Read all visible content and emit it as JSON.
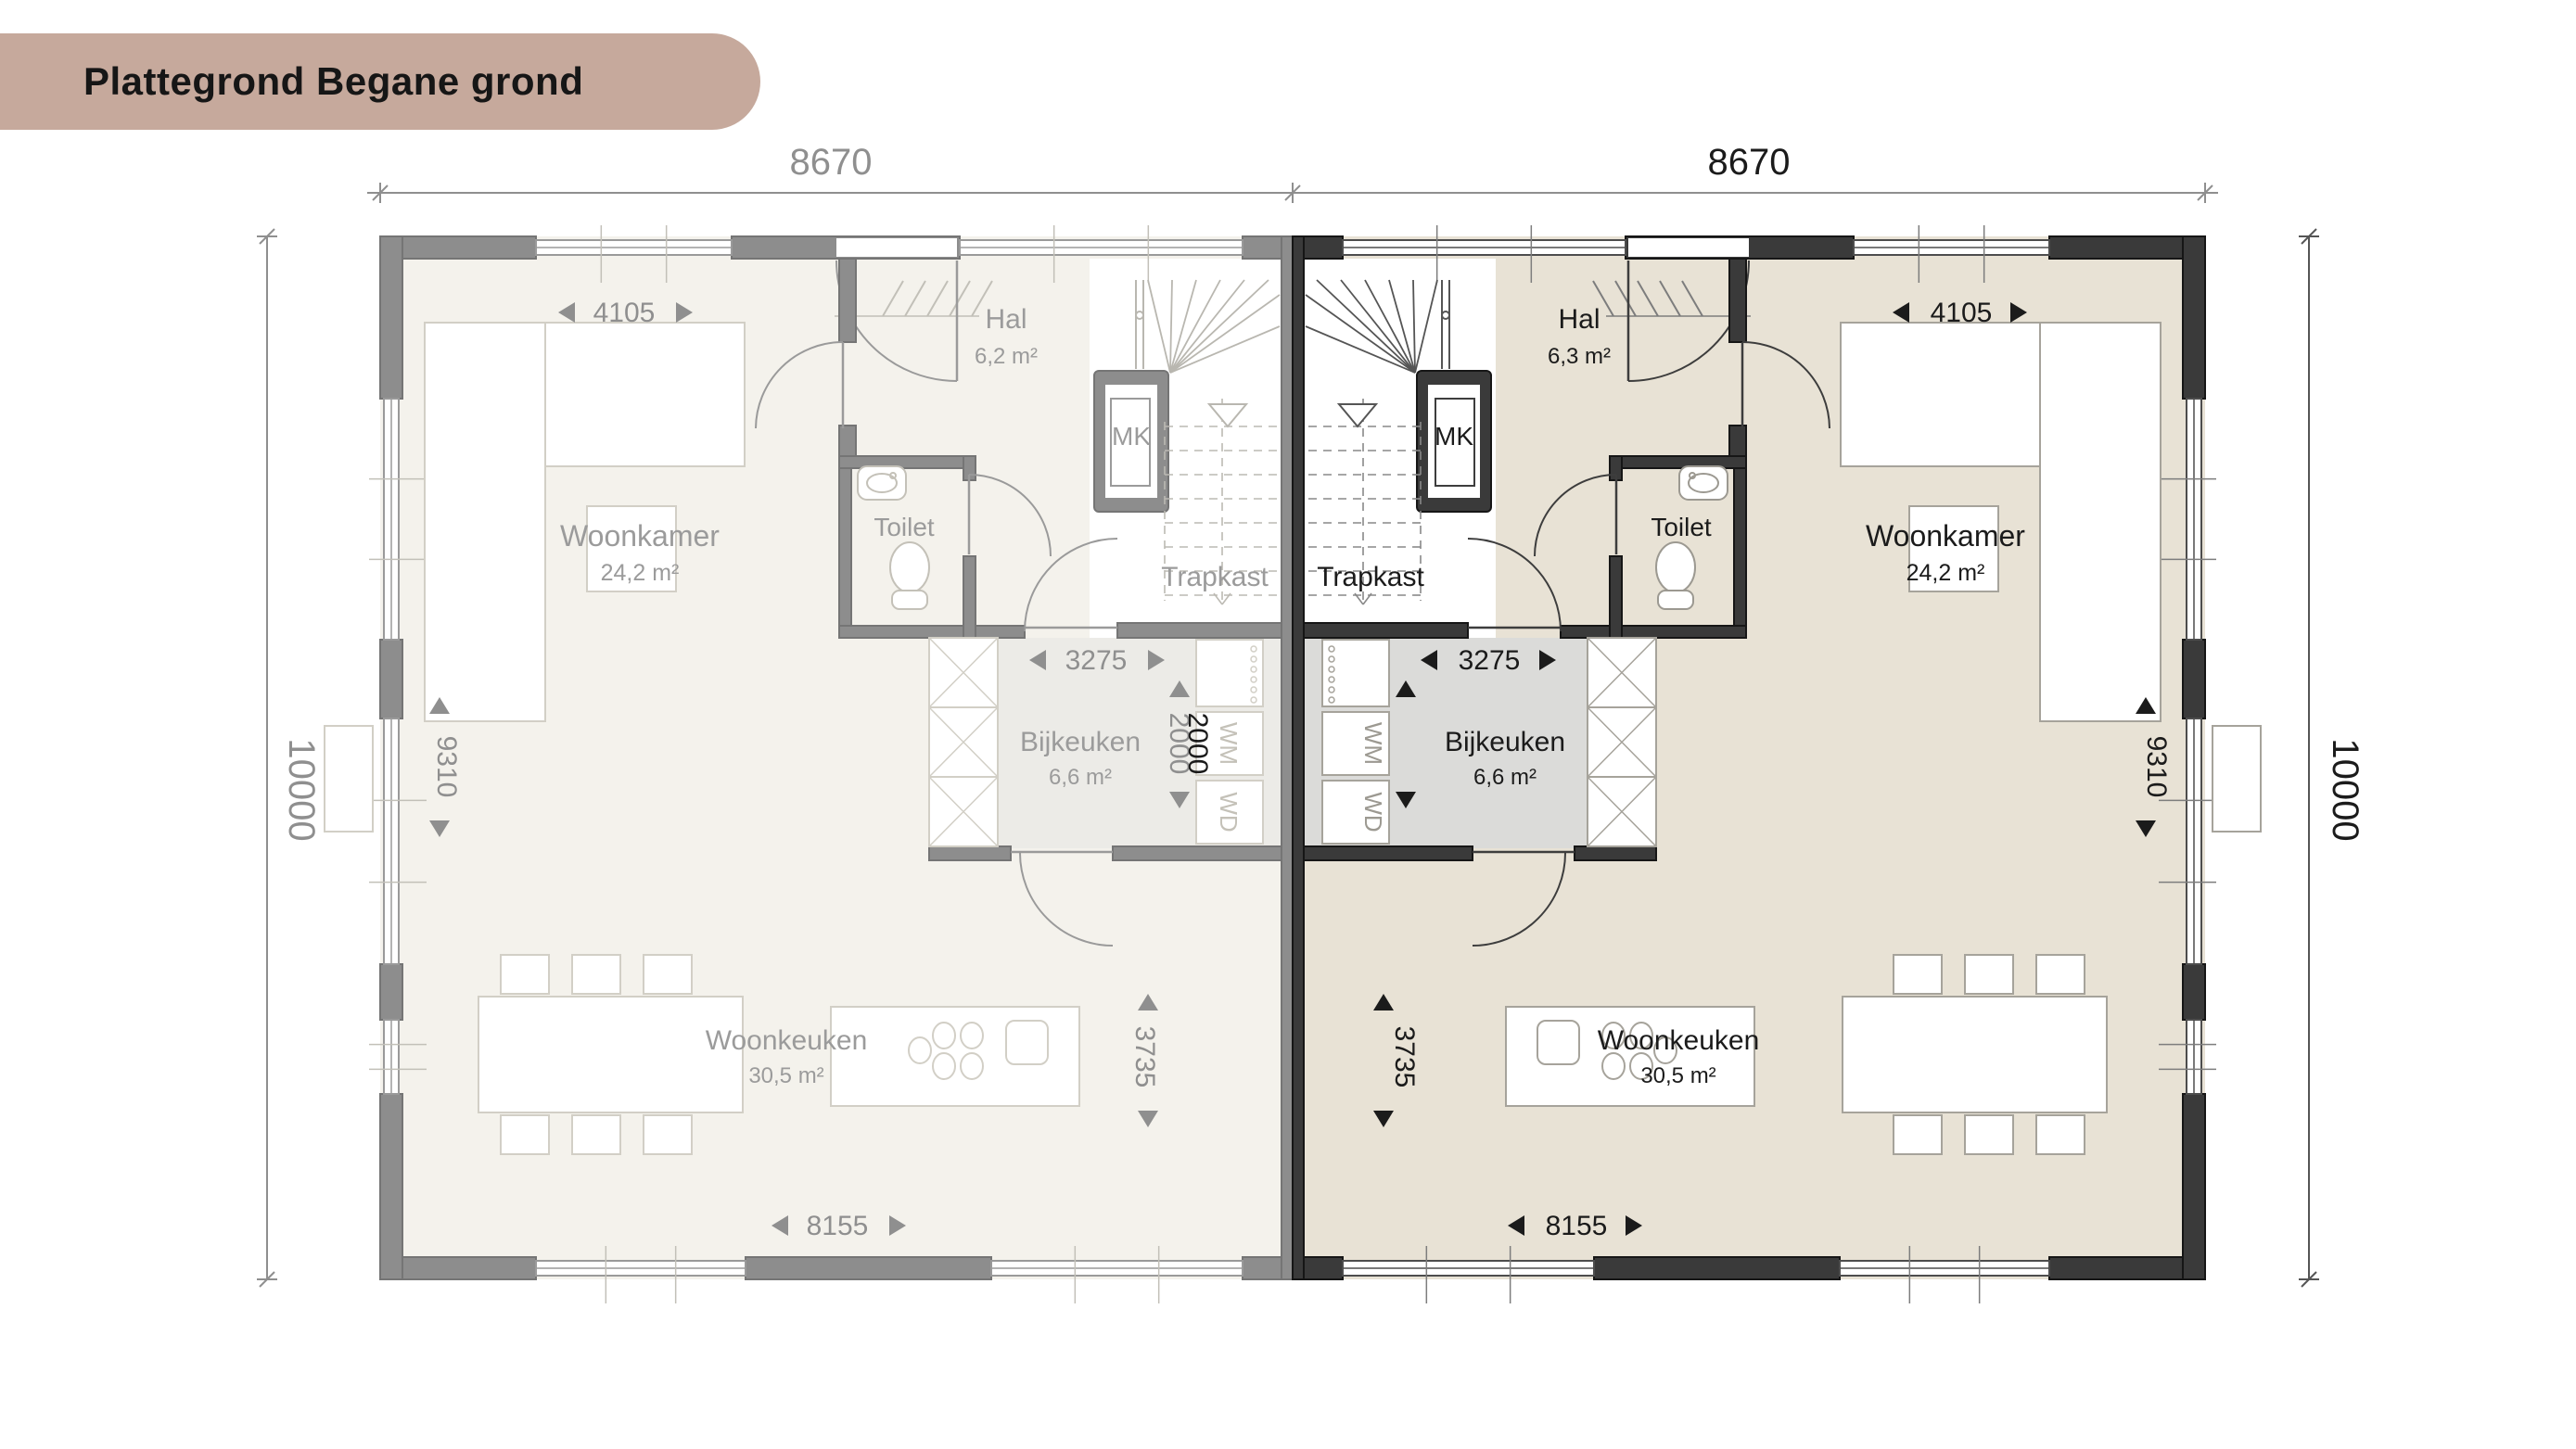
{
  "title": "Plattegrond Begane grond",
  "colors": {
    "badge": "#c6a99c",
    "left_wall": "#8d8d8d",
    "left_floor": "#f4f2ec",
    "right_wall": "#3a3a3a",
    "right_floor": "#e8e2d5",
    "left_dim_text": "#8f8f8f",
    "right_dim_text": "#1b1b1b"
  },
  "overall_dims": {
    "top_left": "8670",
    "top_right": "8670",
    "left_height": "10000",
    "right_height": "10000"
  },
  "left_house": {
    "rooms": {
      "woonkamer": {
        "name": "Woonkamer",
        "area": "24,2 m²"
      },
      "hal": {
        "name": "Hal",
        "area": "6,2 m²"
      },
      "mk": {
        "name": "MK"
      },
      "toilet": {
        "name": "Toilet"
      },
      "trapkast": {
        "name": "Trapkast"
      },
      "bijkeuken": {
        "name": "Bijkeuken",
        "area": "6,6 m²"
      },
      "woonkeuken": {
        "name": "Woonkeuken",
        "area": "30,5 m²"
      }
    },
    "appliances": {
      "wm": "WM",
      "wd": "WD"
    },
    "dims": {
      "woonkamer_width": "4105",
      "woonkamer_depth": "9310",
      "bijkeuken_width": "3275",
      "bijkeuken_depth": "2000",
      "woonkeuken_depth": "3735",
      "woonkeuken_width": "8155"
    }
  },
  "right_house": {
    "rooms": {
      "woonkamer": {
        "name": "Woonkamer",
        "area": "24,2 m²"
      },
      "hal": {
        "name": "Hal",
        "area": "6,3 m²"
      },
      "mk": {
        "name": "MK"
      },
      "toilet": {
        "name": "Toilet"
      },
      "trapkast": {
        "name": "Trapkast"
      },
      "bijkeuken": {
        "name": "Bijkeuken",
        "area": "6,6 m²"
      },
      "woonkeuken": {
        "name": "Woonkeuken",
        "area": "30,5 m²"
      }
    },
    "appliances": {
      "wm": "WM",
      "wd": "WD"
    },
    "dims": {
      "woonkamer_width": "4105",
      "woonkamer_depth": "9310",
      "bijkeuken_width": "3275",
      "bijkeuken_depth": "2000",
      "woonkeuken_depth": "3735",
      "woonkeuken_width": "8155"
    }
  }
}
